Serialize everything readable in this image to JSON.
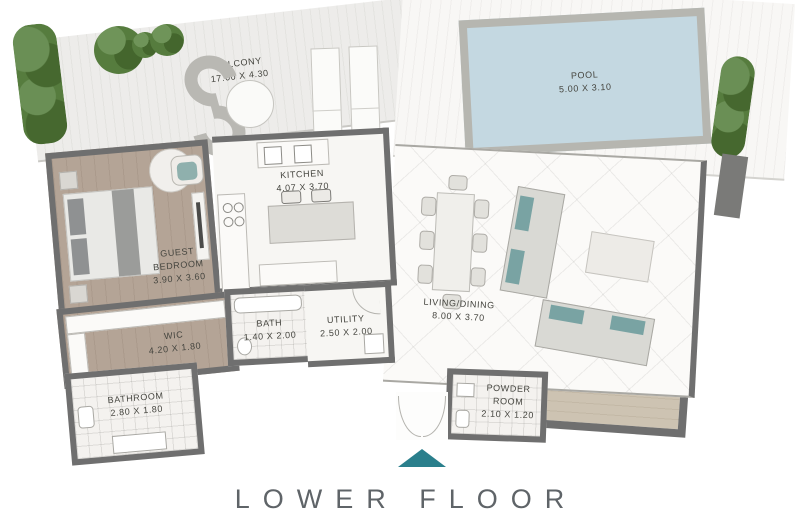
{
  "title": "LOWER FLOOR",
  "colors": {
    "accent_teal": "#2a7f8c",
    "pool_water": "#c4d8e1",
    "wall_gray": "#6f6f6f",
    "wood_floor": "#b4a496",
    "plant_green": "#567c3e",
    "title_gray": "#5f6468"
  },
  "rooms": {
    "balcony": {
      "label": "BALCONY",
      "dims": "17.00 X 4.30"
    },
    "pool": {
      "label": "POOL",
      "dims": "5.00 X 3.10"
    },
    "kitchen": {
      "label": "KITCHEN",
      "dims": "4.07 X 3.70"
    },
    "guest_bedroom": {
      "label": "GUEST BEDROOM",
      "dims": "3.90 X 3.60"
    },
    "wic": {
      "label": "WIC",
      "dims": "4.20 X 1.80"
    },
    "bath": {
      "label": "BATH",
      "dims": "1.40 X 2.00"
    },
    "utility": {
      "label": "UTILITY",
      "dims": "2.50 X 2.00"
    },
    "bathroom": {
      "label": "BATHROOM",
      "dims": "2.80 X 1.80"
    },
    "living_dining": {
      "label": "LIVING/DINING",
      "dims": "8.00 X 3.70"
    },
    "powder_room": {
      "label": "POWDER ROOM",
      "dims": "2.10 X 1.20"
    }
  }
}
